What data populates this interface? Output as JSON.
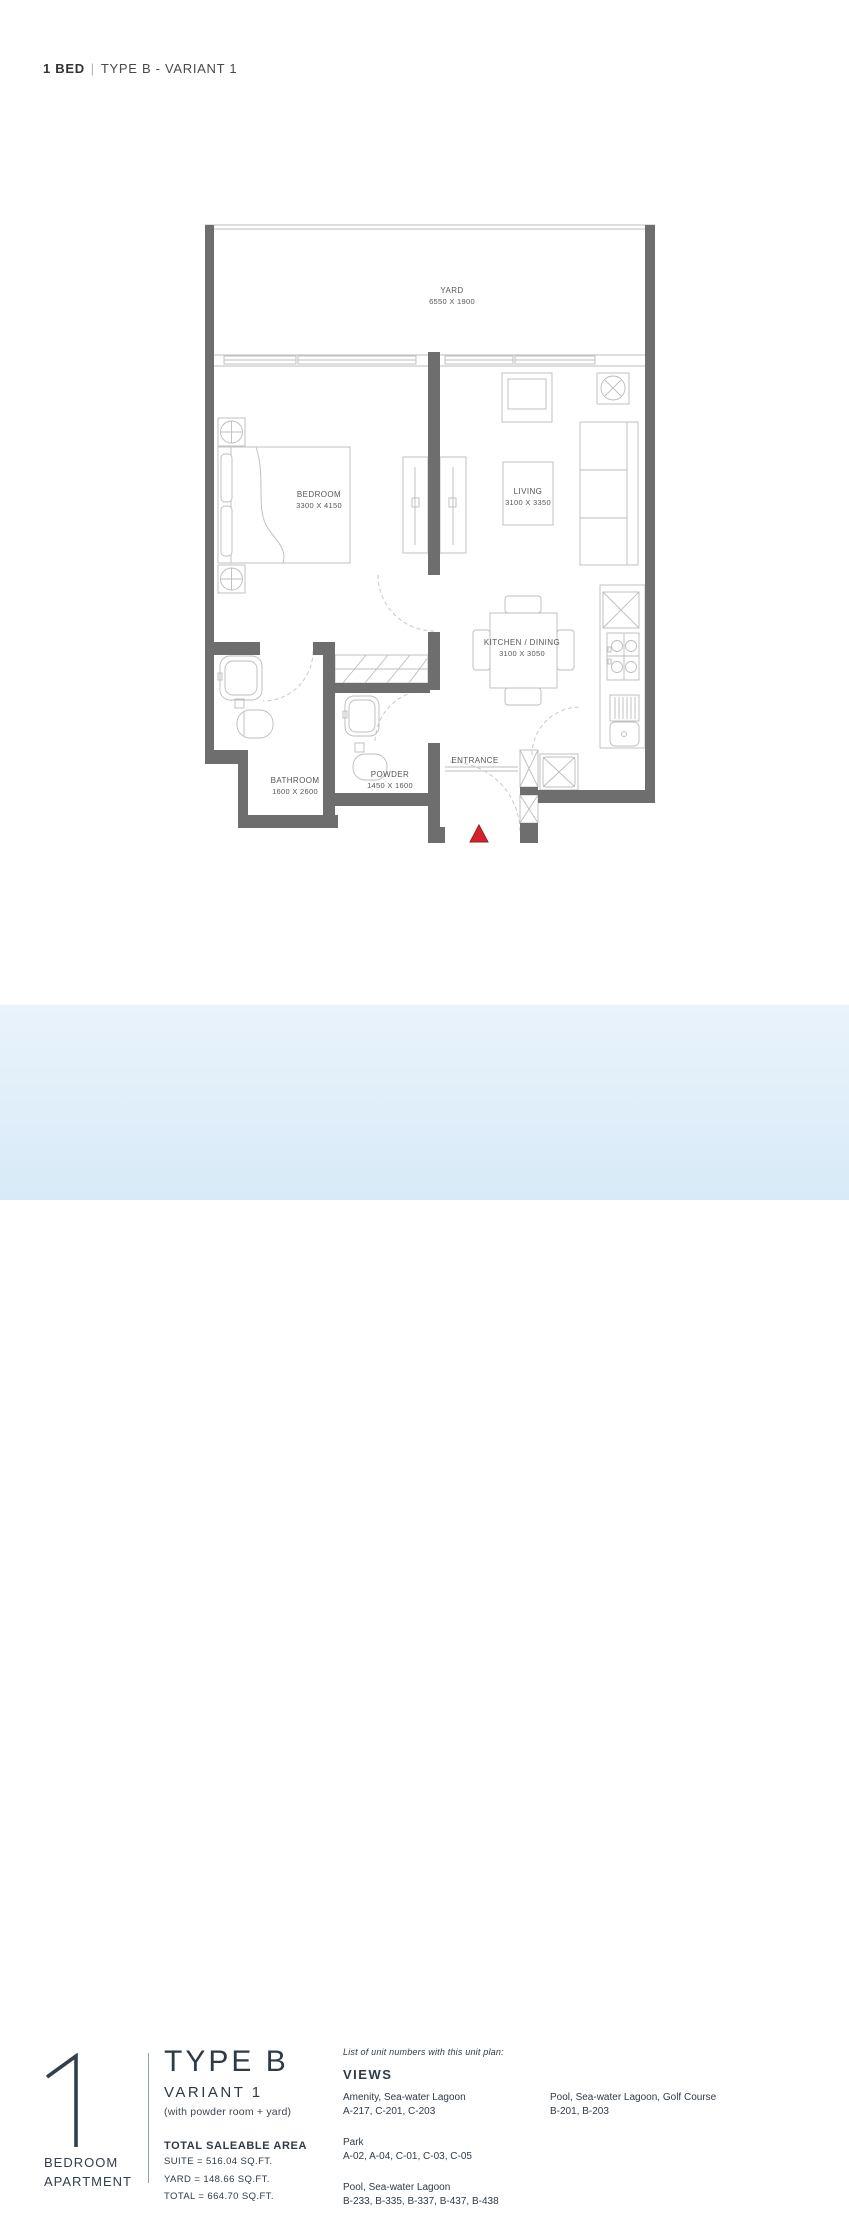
{
  "header": {
    "bed": "1 BED",
    "separator": "|",
    "type": "TYPE B - VARIANT 1"
  },
  "plan": {
    "rooms": {
      "yard": {
        "name": "YARD",
        "dims": "6550 X 1900"
      },
      "bedroom": {
        "name": "BEDROOM",
        "dims": "3300 X 4150"
      },
      "living": {
        "name": "LIVING",
        "dims": "3100 X 3350"
      },
      "kitchen": {
        "name": "KITCHEN / DINING",
        "dims": "3100 X 3050"
      },
      "bathroom": {
        "name": "BATHROOM",
        "dims": "1600 X 2600"
      },
      "powder": {
        "name": "POWDER",
        "dims": "1450 X 1600"
      },
      "entrance": {
        "name": "ENTRANCE"
      }
    }
  },
  "summary": {
    "number": "1",
    "unit_label_line1": "BEDROOM",
    "unit_label_line2": "APARTMENT",
    "type": "TYPE B",
    "variant": "VARIANT 1",
    "note": "(with powder room + yard)",
    "area_title": "TOTAL SALEABLE AREA",
    "areas": [
      "SUITE = 516.04 SQ.FT.",
      "YARD = 148.66 SQ.FT.",
      "TOTAL = 664.70 SQ.FT."
    ]
  },
  "views": {
    "intro": "List of unit numbers with this unit plan:",
    "title": "VIEWS",
    "groups": [
      {
        "view": "Amenity, Sea-water Lagoon",
        "units": "A-217, C-201, C-203"
      },
      {
        "view": "Park",
        "units": "A-02, A-04, C-01, C-03, C-05"
      },
      {
        "view": "Pool, Sea-water Lagoon",
        "units": "B-233, B-335, B-337, B-437, B-438"
      },
      {
        "view": "Pool, Sea-water Lagoon, Golf Course",
        "units": "B-201, B-203"
      }
    ]
  },
  "colors": {
    "wall": "#6e6e6e",
    "entrance_marker": "#d2232a",
    "panel_background": "#dcecf8",
    "text_dark": "#2f3b46"
  }
}
